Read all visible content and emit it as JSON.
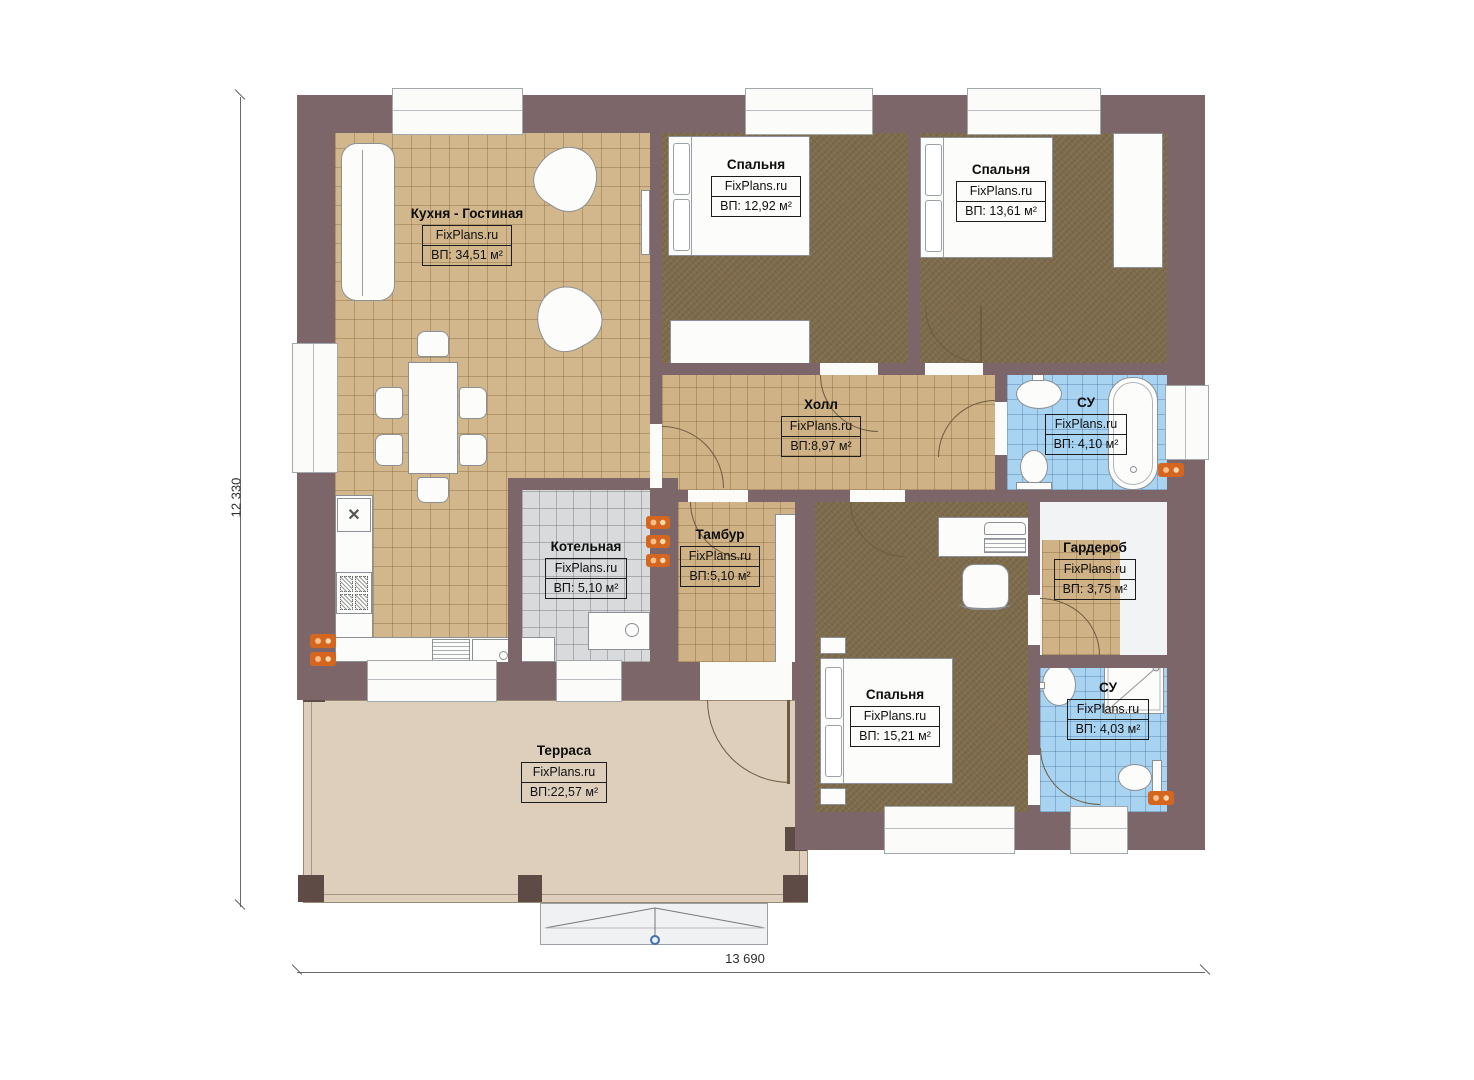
{
  "plan": {
    "brand": "FixPlans.ru",
    "dimensions": {
      "height_label": "12 330",
      "width_label": "13 690"
    },
    "rooms": [
      {
        "id": "kitchen-living",
        "name": "Кухня - Гостиная",
        "brand": "FixPlans.ru",
        "area": "ВП: 34,51 м²"
      },
      {
        "id": "bedroom-1",
        "name": "Спальня",
        "brand": "FixPlans.ru",
        "area": "ВП: 12,92 м²"
      },
      {
        "id": "bedroom-2",
        "name": "Спальня",
        "brand": "FixPlans.ru",
        "area": "ВП: 13,61 м²"
      },
      {
        "id": "hall",
        "name": "Холл",
        "brand": "FixPlans.ru",
        "area": "ВП:8,97 м²"
      },
      {
        "id": "bathroom-1",
        "name": "СУ",
        "brand": "FixPlans.ru",
        "area": "ВП: 4,10 м²"
      },
      {
        "id": "boiler-room",
        "name": "Котельная",
        "brand": "FixPlans.ru",
        "area": "ВП: 5,10 м²"
      },
      {
        "id": "vestibule",
        "name": "Тамбур",
        "brand": "FixPlans.ru",
        "area": "ВП:5,10 м²"
      },
      {
        "id": "wardrobe",
        "name": "Гардероб",
        "brand": "FixPlans.ru",
        "area": "ВП: 3,75 м²"
      },
      {
        "id": "bedroom-3",
        "name": "Спальня",
        "brand": "FixPlans.ru",
        "area": "ВП: 15,21 м²"
      },
      {
        "id": "bathroom-2",
        "name": "СУ",
        "brand": "FixPlans.ru",
        "area": "ВП: 4,03 м²"
      },
      {
        "id": "terrace",
        "name": "Терраса",
        "brand": "FixPlans.ru",
        "area": "ВП:22,57 м²"
      }
    ],
    "colors": {
      "wall": "#7c666a",
      "tile_tan": "#d3b78c",
      "carpet": "#7d6a4b",
      "tile_blue": "#a9d4f1",
      "tile_gray": "#d9dadb",
      "terrace": "#ddcfbc",
      "radiator": "#d4661f",
      "marker_blue": "#3f6fae"
    }
  }
}
